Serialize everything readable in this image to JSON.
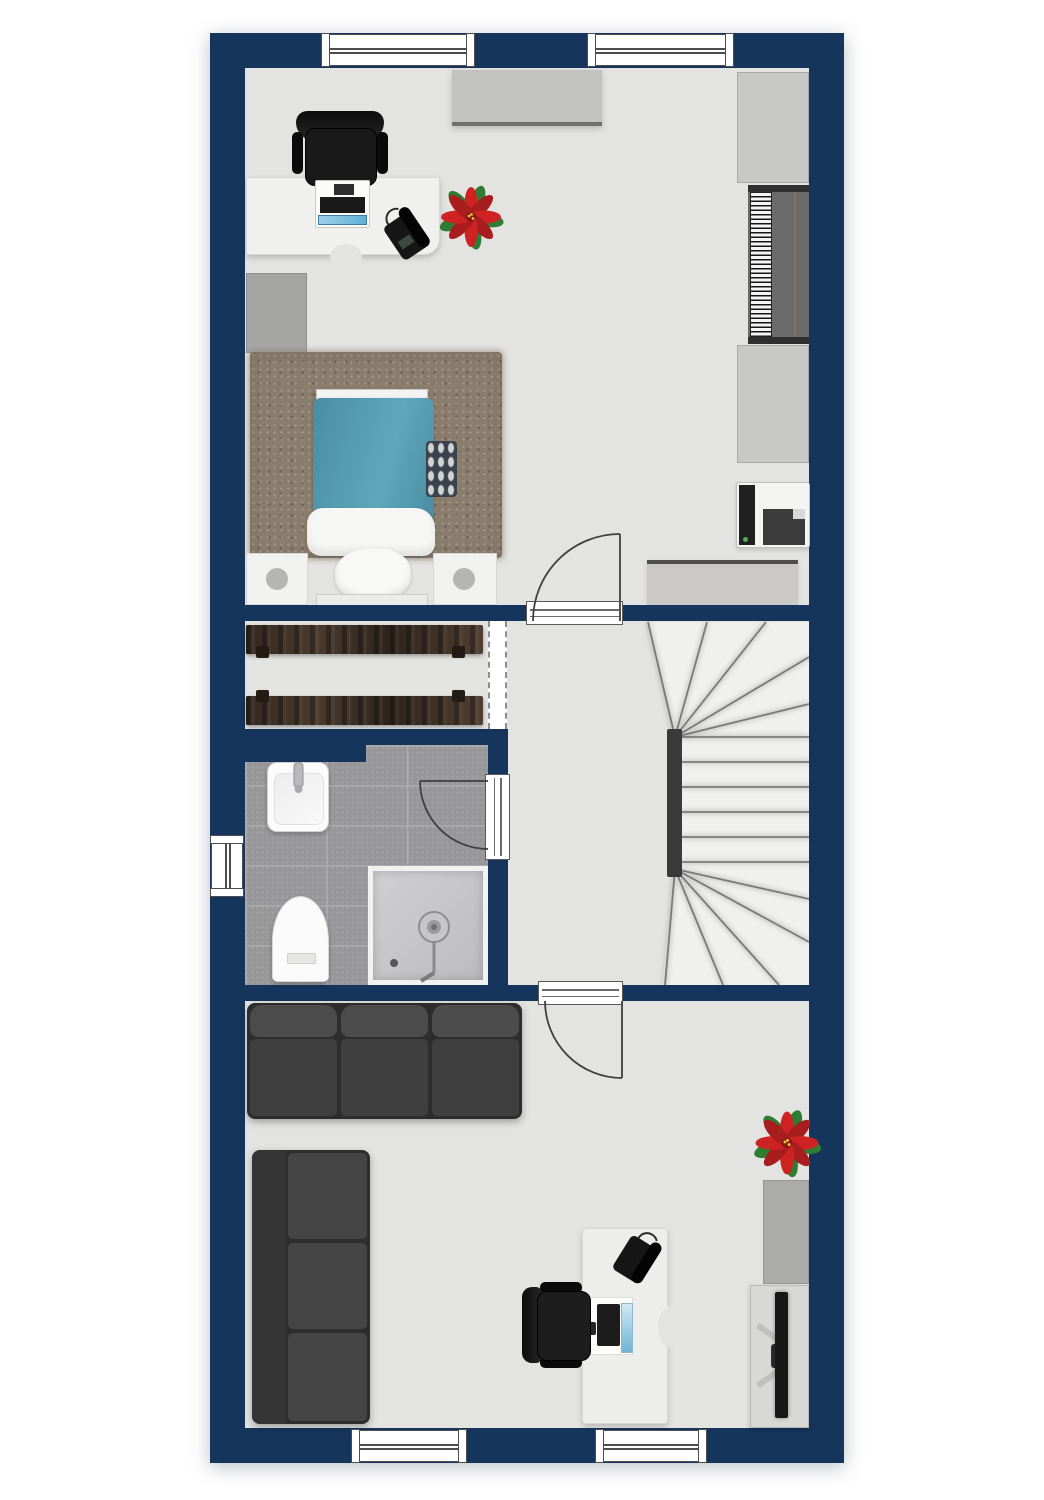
{
  "plan": {
    "type": "floor-plan-top-view",
    "storey": "upper-floor",
    "rooms": [
      {
        "id": "bedroom",
        "position": "top",
        "furniture": [
          "desk",
          "office-chair",
          "desktop-printer",
          "telephone",
          "poinsettia-plant",
          "wall-dresser",
          "wardrobe-north",
          "piano",
          "wardrobe-south",
          "west-cabinet",
          "rug",
          "single-bed",
          "nightstand-left",
          "nightstand-right",
          "south-sideboard",
          "printer-fax-unit"
        ]
      },
      {
        "id": "closet",
        "position": "middle-left",
        "furniture": [
          "wardrobe-rail-top",
          "wardrobe-rail-bottom"
        ]
      },
      {
        "id": "bathroom",
        "position": "middle-left-lower",
        "furniture": [
          "washbasin",
          "toilet",
          "shower"
        ]
      },
      {
        "id": "landing",
        "position": "middle-right",
        "furniture": [
          "winder-staircase"
        ]
      },
      {
        "id": "living-room",
        "position": "bottom",
        "furniture": [
          "sofa-three-seat-top",
          "sofa-three-seat-left",
          "desk",
          "computer-workstation",
          "office-chair",
          "telephone",
          "poinsettia-plant",
          "east-cabinet",
          "tv-console",
          "television"
        ]
      }
    ],
    "openings": {
      "windows": [
        "top-left",
        "top-right",
        "west",
        "bottom-left",
        "bottom-right"
      ],
      "doors": [
        "bedroom-door",
        "bathroom-door",
        "living-room-door"
      ],
      "passages": [
        "closet-passage"
      ]
    }
  },
  "palette": {
    "wall": "#16355C",
    "floor": "#E3E3E1",
    "tile": "#97979A",
    "rug": "#8B7D6C",
    "duvet": "#4F94AA",
    "sofa": "#3E3E3E",
    "wood_rail": "#3F3023",
    "plant_red": "#C62828",
    "plant_green": "#2E7D32",
    "stair_tread": "#F0F0EF",
    "stair_newel": "#3A3A3A"
  }
}
